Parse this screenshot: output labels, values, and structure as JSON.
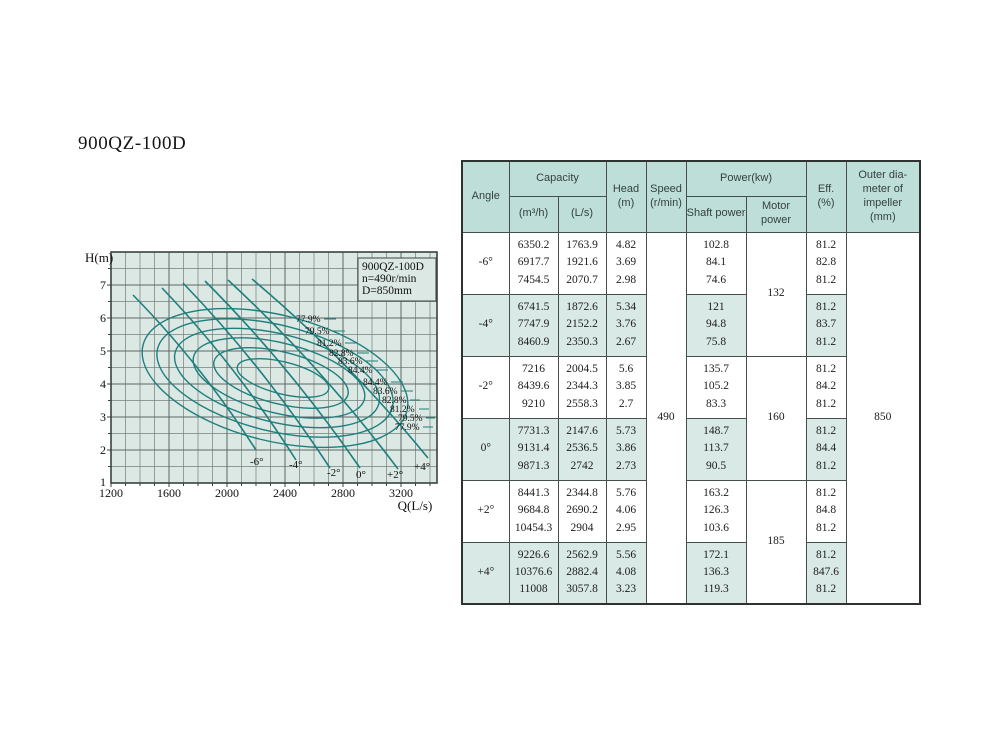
{
  "page": {
    "title": "900QZ-100D"
  },
  "colors": {
    "chart_background": "#dce8e4",
    "grid_line": "#6b7672",
    "curve": "#1e7f7d",
    "table_header_background": "#bedfd9",
    "table_row_shade": "#d9e9e5",
    "table_border": "#2e3331"
  },
  "chart": {
    "y_axis_label": "H(m)",
    "x_axis_label": "Q(L/s)",
    "y_ticks": [
      "7",
      "6",
      "5",
      "4",
      "3",
      "2",
      "1"
    ],
    "x_ticks": [
      "1200",
      "1600",
      "2000",
      "2400",
      "2800",
      "3200"
    ],
    "legend": {
      "model": "900QZ-100D",
      "speed": "n=490r/min",
      "diameter": "D=850mm"
    },
    "angle_labels": [
      "-6°",
      "-4°",
      "-2°",
      "0°",
      "+2°",
      "+4°"
    ],
    "eff_labels_upper": [
      "77.9%",
      "79.5%",
      "81.2%",
      "82.8%",
      "83.6%",
      "84.4%"
    ],
    "eff_labels_lower": [
      "84.4%",
      "83.6%",
      "82.8%",
      "81.2%",
      "79.5%",
      "77.9%"
    ]
  },
  "chart_data": {
    "type": "line",
    "title": "900QZ-100D head-capacity curves with efficiency contours",
    "xlabel": "Q(L/s)",
    "ylabel": "H(m)",
    "xlim": [
      1200,
      3450
    ],
    "ylim": [
      1,
      8
    ],
    "x_tick_values": [
      1200,
      1600,
      2000,
      2400,
      2800,
      3200
    ],
    "y_tick_values": [
      1,
      2,
      3,
      4,
      5,
      6,
      7
    ],
    "grid": true,
    "annotation": [
      "900QZ-100D",
      "n=490r/min",
      "D=850mm"
    ],
    "series": [
      {
        "name": "-6°",
        "x": [
          1763.9,
          1921.6,
          2070.7
        ],
        "y": [
          4.82,
          3.69,
          2.98
        ]
      },
      {
        "name": "-4°",
        "x": [
          1872.6,
          2152.2,
          2350.3
        ],
        "y": [
          5.34,
          3.76,
          2.67
        ]
      },
      {
        "name": "-2°",
        "x": [
          2004.5,
          2344.3,
          2558.3
        ],
        "y": [
          5.6,
          3.85,
          2.7
        ]
      },
      {
        "name": "0°",
        "x": [
          2147.6,
          2536.5,
          2742
        ],
        "y": [
          5.73,
          3.86,
          2.73
        ]
      },
      {
        "name": "+2°",
        "x": [
          2344.8,
          2690.2,
          2904
        ],
        "y": [
          5.76,
          4.06,
          2.95
        ]
      },
      {
        "name": "+4°",
        "x": [
          2562.9,
          2882.4,
          3057.8
        ],
        "y": [
          5.56,
          4.08,
          3.23
        ]
      }
    ],
    "efficiency_contours_pct": [
      77.9,
      79.5,
      81.2,
      82.8,
      83.6,
      84.4
    ]
  },
  "table": {
    "headers": {
      "angle": "Angle",
      "capacity": "Capacity",
      "m3h": "(m³/h)",
      "ls": "(L/s)",
      "head": [
        "Head",
        "(m)"
      ],
      "speed": [
        "Speed",
        "(r/min)"
      ],
      "power": "Power(kw)",
      "shaft": "Shaft power",
      "motor": "Motor power",
      "eff": [
        "Eff.",
        "(%)"
      ],
      "outer": [
        "Outer dia-",
        "meter of",
        "impeller",
        "(mm)"
      ]
    },
    "speed_value": "490",
    "outer_diameter_value": "850",
    "motor_powers": [
      "132",
      "160",
      "185"
    ],
    "rows": [
      {
        "angle": "-6°",
        "m3h": [
          "6350.2",
          "6917.7",
          "7454.5"
        ],
        "ls": [
          "1763.9",
          "1921.6",
          "2070.7"
        ],
        "head": [
          "4.82",
          "3.69",
          "2.98"
        ],
        "shaft": [
          "102.8",
          "84.1",
          "74.6"
        ],
        "eff": [
          "81.2",
          "82.8",
          "81.2"
        ]
      },
      {
        "angle": "-4°",
        "m3h": [
          "6741.5",
          "7747.9",
          "8460.9"
        ],
        "ls": [
          "1872.6",
          "2152.2",
          "2350.3"
        ],
        "head": [
          "5.34",
          "3.76",
          "2.67"
        ],
        "shaft": [
          "121",
          "94.8",
          "75.8"
        ],
        "eff": [
          "81.2",
          "83.7",
          "81.2"
        ]
      },
      {
        "angle": "-2°",
        "m3h": [
          "7216",
          "8439.6",
          "9210"
        ],
        "ls": [
          "2004.5",
          "2344.3",
          "2558.3"
        ],
        "head": [
          "5.6",
          "3.85",
          "2.7"
        ],
        "shaft": [
          "135.7",
          "105.2",
          "83.3"
        ],
        "eff": [
          "81.2",
          "84.2",
          "81.2"
        ]
      },
      {
        "angle": "0°",
        "m3h": [
          "7731.3",
          "9131.4",
          "9871.3"
        ],
        "ls": [
          "2147.6",
          "2536.5",
          "2742"
        ],
        "head": [
          "5.73",
          "3.86",
          "2.73"
        ],
        "shaft": [
          "148.7",
          "113.7",
          "90.5"
        ],
        "eff": [
          "81.2",
          "84.4",
          "81.2"
        ]
      },
      {
        "angle": "+2°",
        "m3h": [
          "8441.3",
          "9684.8",
          "10454.3"
        ],
        "ls": [
          "2344.8",
          "2690.2",
          "2904"
        ],
        "head": [
          "5.76",
          "4.06",
          "2.95"
        ],
        "shaft": [
          "163.2",
          "126.3",
          "103.6"
        ],
        "eff": [
          "81.2",
          "84.8",
          "81.2"
        ]
      },
      {
        "angle": "+4°",
        "m3h": [
          "9226.6",
          "10376.6",
          "11008"
        ],
        "ls": [
          "2562.9",
          "2882.4",
          "3057.8"
        ],
        "head": [
          "5.56",
          "4.08",
          "3.23"
        ],
        "shaft": [
          "172.1",
          "136.3",
          "119.3"
        ],
        "eff": [
          "81.2",
          "847.6",
          "81.2"
        ]
      }
    ]
  }
}
